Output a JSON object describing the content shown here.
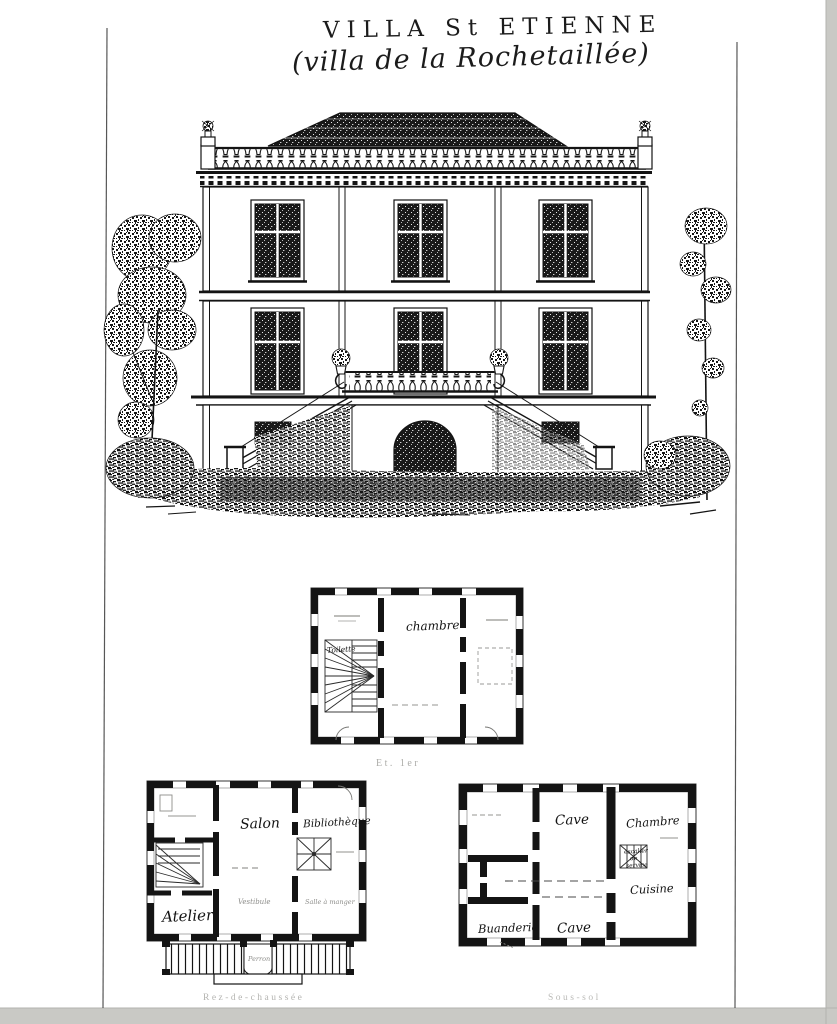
{
  "title": {
    "line1": "VILLA St ETIENNE",
    "line2": "(villa de la Rochetaillée)"
  },
  "plans": {
    "etage": {
      "caption": "Et. 1er",
      "rooms": {
        "chambre": "chambre",
        "toilette": "Toilette"
      }
    },
    "rdc": {
      "caption": "Rez-de-chaussée",
      "rooms": {
        "salon": "Salon",
        "bibliotheque": "Bibliothèque",
        "atelier": "Atelier",
        "vestibule": "Vestibule",
        "salle_a_manger": "Salle à manger",
        "perron": "Perron"
      }
    },
    "sous_sol": {
      "caption": "Sous-sol",
      "rooms": {
        "cave_nord": "Cave",
        "chambre": "Chambre",
        "cuisine": "Cuisine",
        "buanderie": "Buanderie",
        "cave_sud": "Cave",
        "escalier_l1": "escalier",
        "escalier_l2": "de",
        "escalier_l3": "service"
      }
    }
  },
  "colors": {
    "ink": "#1c1c1c",
    "paper": "#ffffff",
    "scanner_edge": "#c9c9c5"
  }
}
